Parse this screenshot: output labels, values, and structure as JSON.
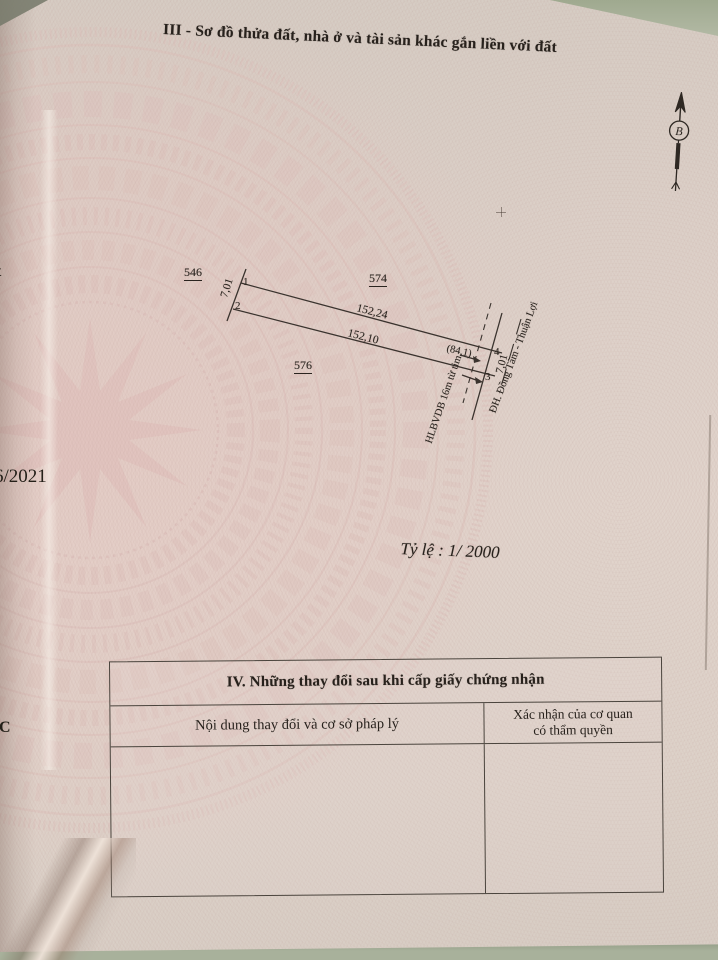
{
  "colors": {
    "background_surface": "#a9b29d",
    "paper": "#ddd2c9",
    "pattern_pink": "#dcbfba",
    "ink": "#27211c"
  },
  "document": {
    "section3_title": "III - Sơ đồ thửa đất, nhà ở và tài sản khác gắn liền với đất",
    "scale_label": "Tỷ lệ : 1/ 2000",
    "north_label": "B"
  },
  "diagram": {
    "parcel_left": "546",
    "parcel_top": "574",
    "parcel_bottom": "576",
    "corner_1": "1",
    "corner_2": "2",
    "corner_3": "3",
    "corner_4": "4",
    "dim_left": "7,01",
    "dim_top": "152,24",
    "dim_bottom": "152,10",
    "dim_right": "7,01",
    "dim_frontage": "(84,1)",
    "corridor_label": "HLBVDB 16m từ tim",
    "road_name": "ĐH. Đồng Tâm - Thuận Lợi"
  },
  "section4": {
    "title": "IV. Những thay đổi sau khi cấp giấy chứng nhận",
    "col_content_header": "Nội dung thay đổi và cơ sở pháp lý",
    "col_confirm_line1": "Xác nhận của cơ quan",
    "col_confirm_line2": "có thẩm quyền"
  },
  "edge_fragments": {
    "partial_letter": "t",
    "partial_date": "6/2021",
    "partial_mark": "5C"
  }
}
